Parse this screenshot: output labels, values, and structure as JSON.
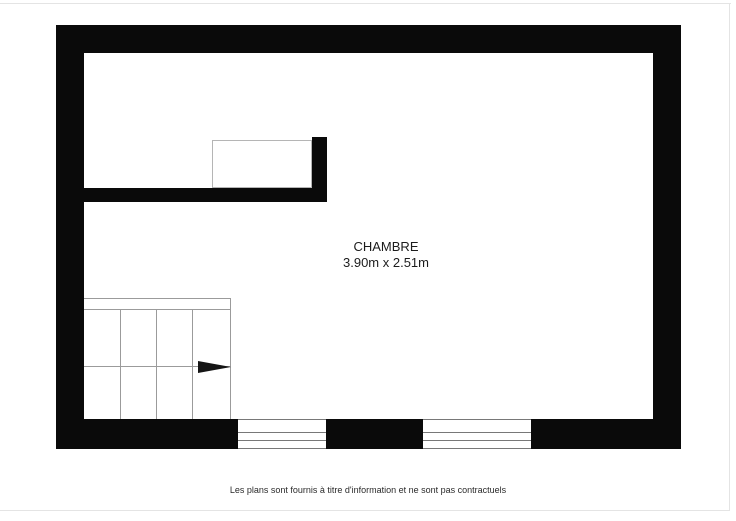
{
  "plan": {
    "room": {
      "label": "CHAMBRE",
      "dimensions": "3.90m x 2.51m"
    }
  },
  "footer": {
    "disclaimer": "Les plans sont fournis à titre d'information et ne sont pas contractuels"
  },
  "icons": {
    "stairs_direction_arrow": "right-pointing-solid-triangle"
  },
  "colors": {
    "wall": "#0a0a0a",
    "stair_line": "#9b9b9b",
    "niche_border": "#b5b5b5",
    "window_line": "#787878",
    "page_frame": "#e4e4e4",
    "text": "#1c1c1c",
    "background": "#ffffff"
  }
}
